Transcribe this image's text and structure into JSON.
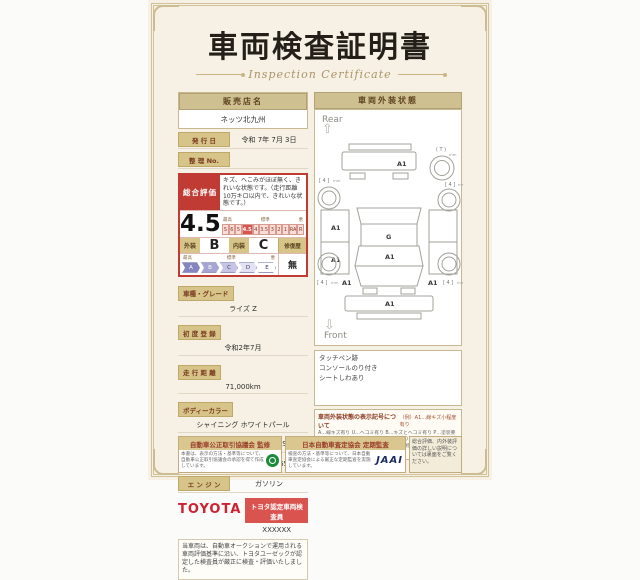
{
  "title": {
    "main": "車両検査証明書",
    "sub": "Inspection Certificate"
  },
  "dealer": {
    "label": "販売店名",
    "value": "ネッツ北九州"
  },
  "issue_date": {
    "label": "発 行 日",
    "value": "令和 7年 7月 3日"
  },
  "ref_no": {
    "label": "整 理 No.",
    "value": ""
  },
  "rating": {
    "label": "総合評価",
    "score": "4.5",
    "comment": "キズ、へこみがほぼ無く、きれいな状態です。（走行距離10万キロ以内で、きれいな状態です。）",
    "scale_best": "最高",
    "scale_mid": "標準",
    "scale_worst": "悪",
    "scale": [
      "S",
      "6",
      "5",
      "4.5",
      "4",
      "3.5",
      "3",
      "2",
      "1",
      "RA",
      "R"
    ],
    "exterior_label": "外装",
    "exterior_value": "B",
    "interior_label": "内装",
    "interior_value": "C",
    "repair_label": "修復歴",
    "repair_value": "無",
    "letter_scale": [
      "A",
      "B",
      "C",
      "D",
      "E"
    ]
  },
  "specs": [
    {
      "label": "車種・グレード",
      "value": "ライズ Z"
    },
    {
      "label": "初 度 登 録",
      "value": "令和2年7月"
    },
    {
      "label": "走 行 距 離",
      "value": "71,000km"
    },
    {
      "label": "ボディーカラー",
      "value": "シャイニング ホワイトパール"
    },
    {
      "label": "型　　式",
      "value": "A200A-GBSV"
    },
    {
      "label": "車 台 番 号",
      "value": "XXXXXXX659"
    },
    {
      "label": "エ ン ジ ン",
      "value": "ガソリン"
    }
  ],
  "inspector": {
    "brand": "TOYOTA",
    "badge": "トヨタ認定車両検査員",
    "code": "XXXXXX"
  },
  "disclaimer": "当車両は、自動車オークションで運用される車両評価基準に沿い、トヨタユーゼックが認定した検査員が厳正に検査・評価いたしました。",
  "exterior_panel": {
    "header": "車両外装状態",
    "rear_label": "Rear",
    "front_label": "Front",
    "diagram": {
      "spare_label": "( T )",
      "tire_label": "[ 4 ]",
      "tire_unit": "mm",
      "rear_bumper": "A1",
      "left_quarter": "A1",
      "left_door": "A1",
      "roof": "G",
      "windshield": "A1",
      "left_fender": "A1",
      "right_fender": "A1",
      "front_bumper": "A1"
    },
    "notes": [
      "タッチペン跡",
      "コンソールのり付き",
      "シートしわあり"
    ],
    "legend_title": "車両外装状態の表示記号について",
    "legend_example": "（例）A1…線キズ小程度有り",
    "legend_body": "A…線キズ有り U…ヘコミ有り B…キズとヘコミ有り P…塗装要 W…補修跡有り S…サビ有り C…腐食有り O…ガラスキズ有り X…要交換 XX…交換済 1…小程度 2…中程度 3…中程度以上 ※タイヤ等の表示は別の表記をしています。"
  },
  "footer": {
    "fair_trade_title": "自動車公正取引協議会 監修",
    "fair_trade_body": "本書は、表示の方法・基準等について、自動車公正取引協議会の承認を得て作成しています。",
    "jaai_title": "日本自動車査定協会 定期監査",
    "jaai_body": "検査の方法・基準等について、日本自動車査定協会による厳正な定期監査を実施しています。",
    "jaai_logo": "JAAI",
    "back_note": "総合評価、内外装評価の詳しい説明については裏面をご覧ください。"
  }
}
